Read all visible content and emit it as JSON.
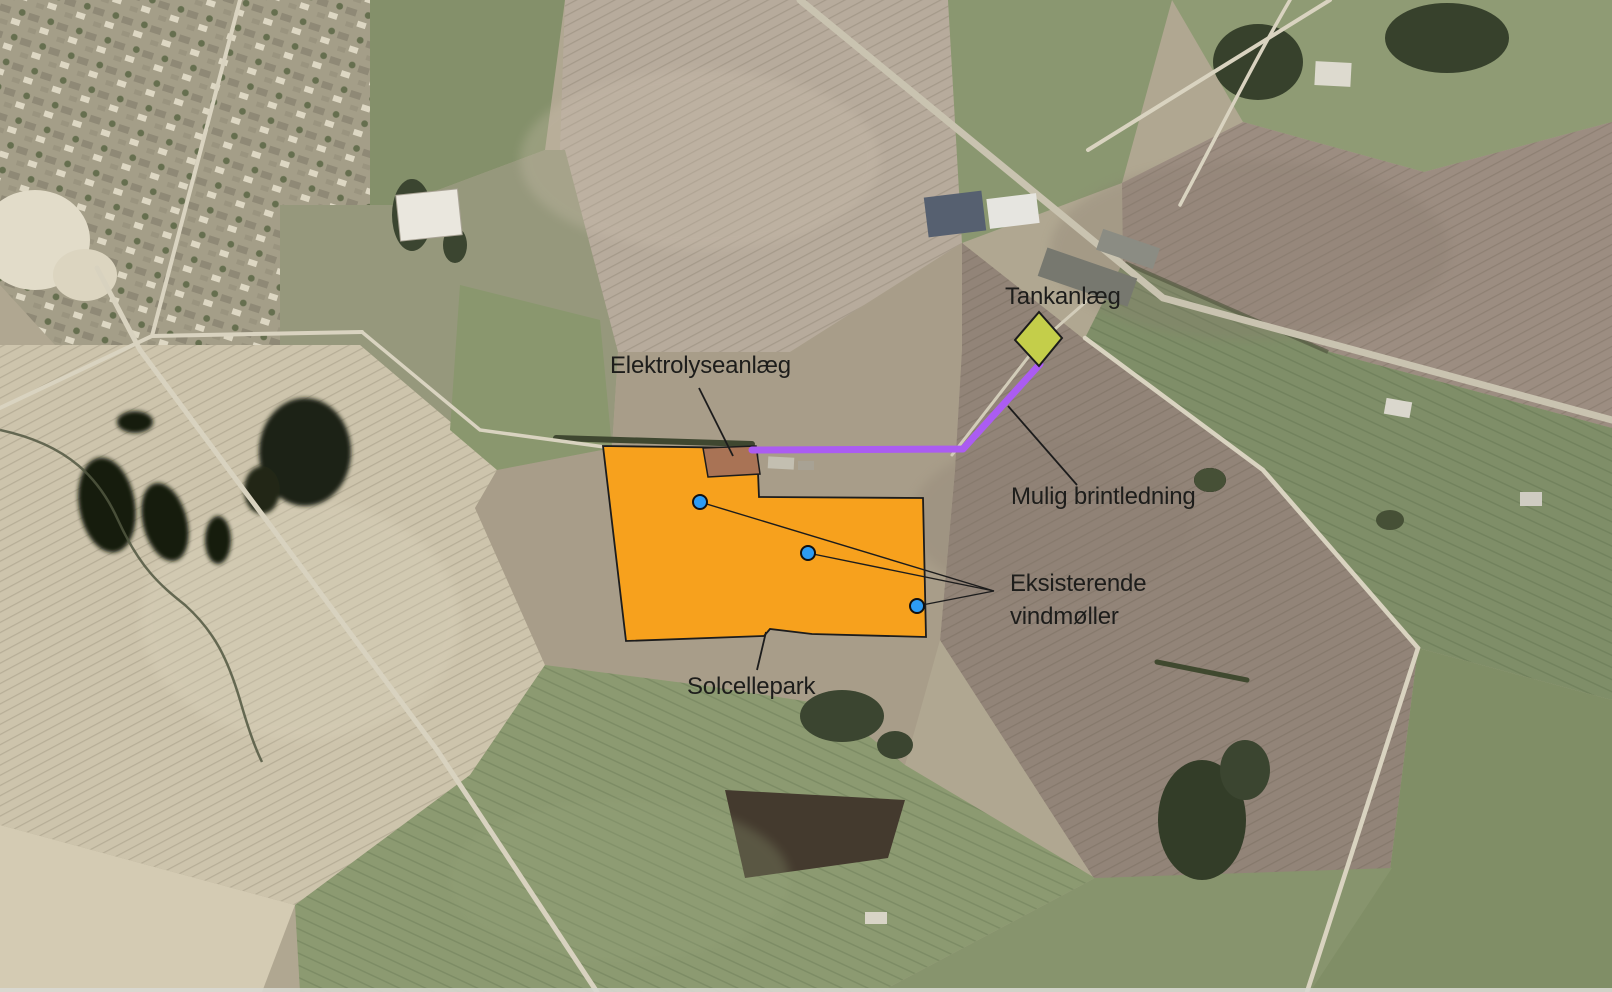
{
  "map": {
    "labels": {
      "tank_facility": "Tankanlæg",
      "electrolysis_plant": "Elektrolyseanlæg",
      "hydrogen_pipeline": "Mulig brintledning",
      "existing_turbines_line1": "Eksisterende",
      "existing_turbines_line2": "vindmøller",
      "solar_park": "Solcellepark"
    },
    "colors": {
      "solar_area": "#F7A11D",
      "electrolysis_area": "#A97355",
      "tank_area": "#C4CE4A",
      "pipeline_line": "#AB5CF2",
      "turbine_dot": "#2D9CF4",
      "annotation_text": "#1d1d1b",
      "leader_line": "#1c1c1c",
      "shape_outline": "#1c1c1c"
    },
    "wind_turbine_count": 3
  }
}
